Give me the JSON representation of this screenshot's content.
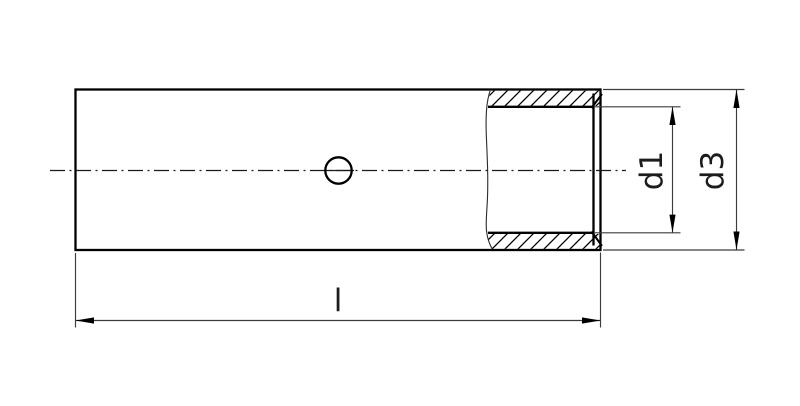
{
  "drawing": {
    "type": "technical-drawing-section-view",
    "dimension_labels": {
      "length": "l",
      "inner_diameter": "d1",
      "outer_diameter": "d3"
    },
    "colors": {
      "line": "#000000",
      "thin_line": "#3c3c3c",
      "background": "#ffffff"
    }
  }
}
